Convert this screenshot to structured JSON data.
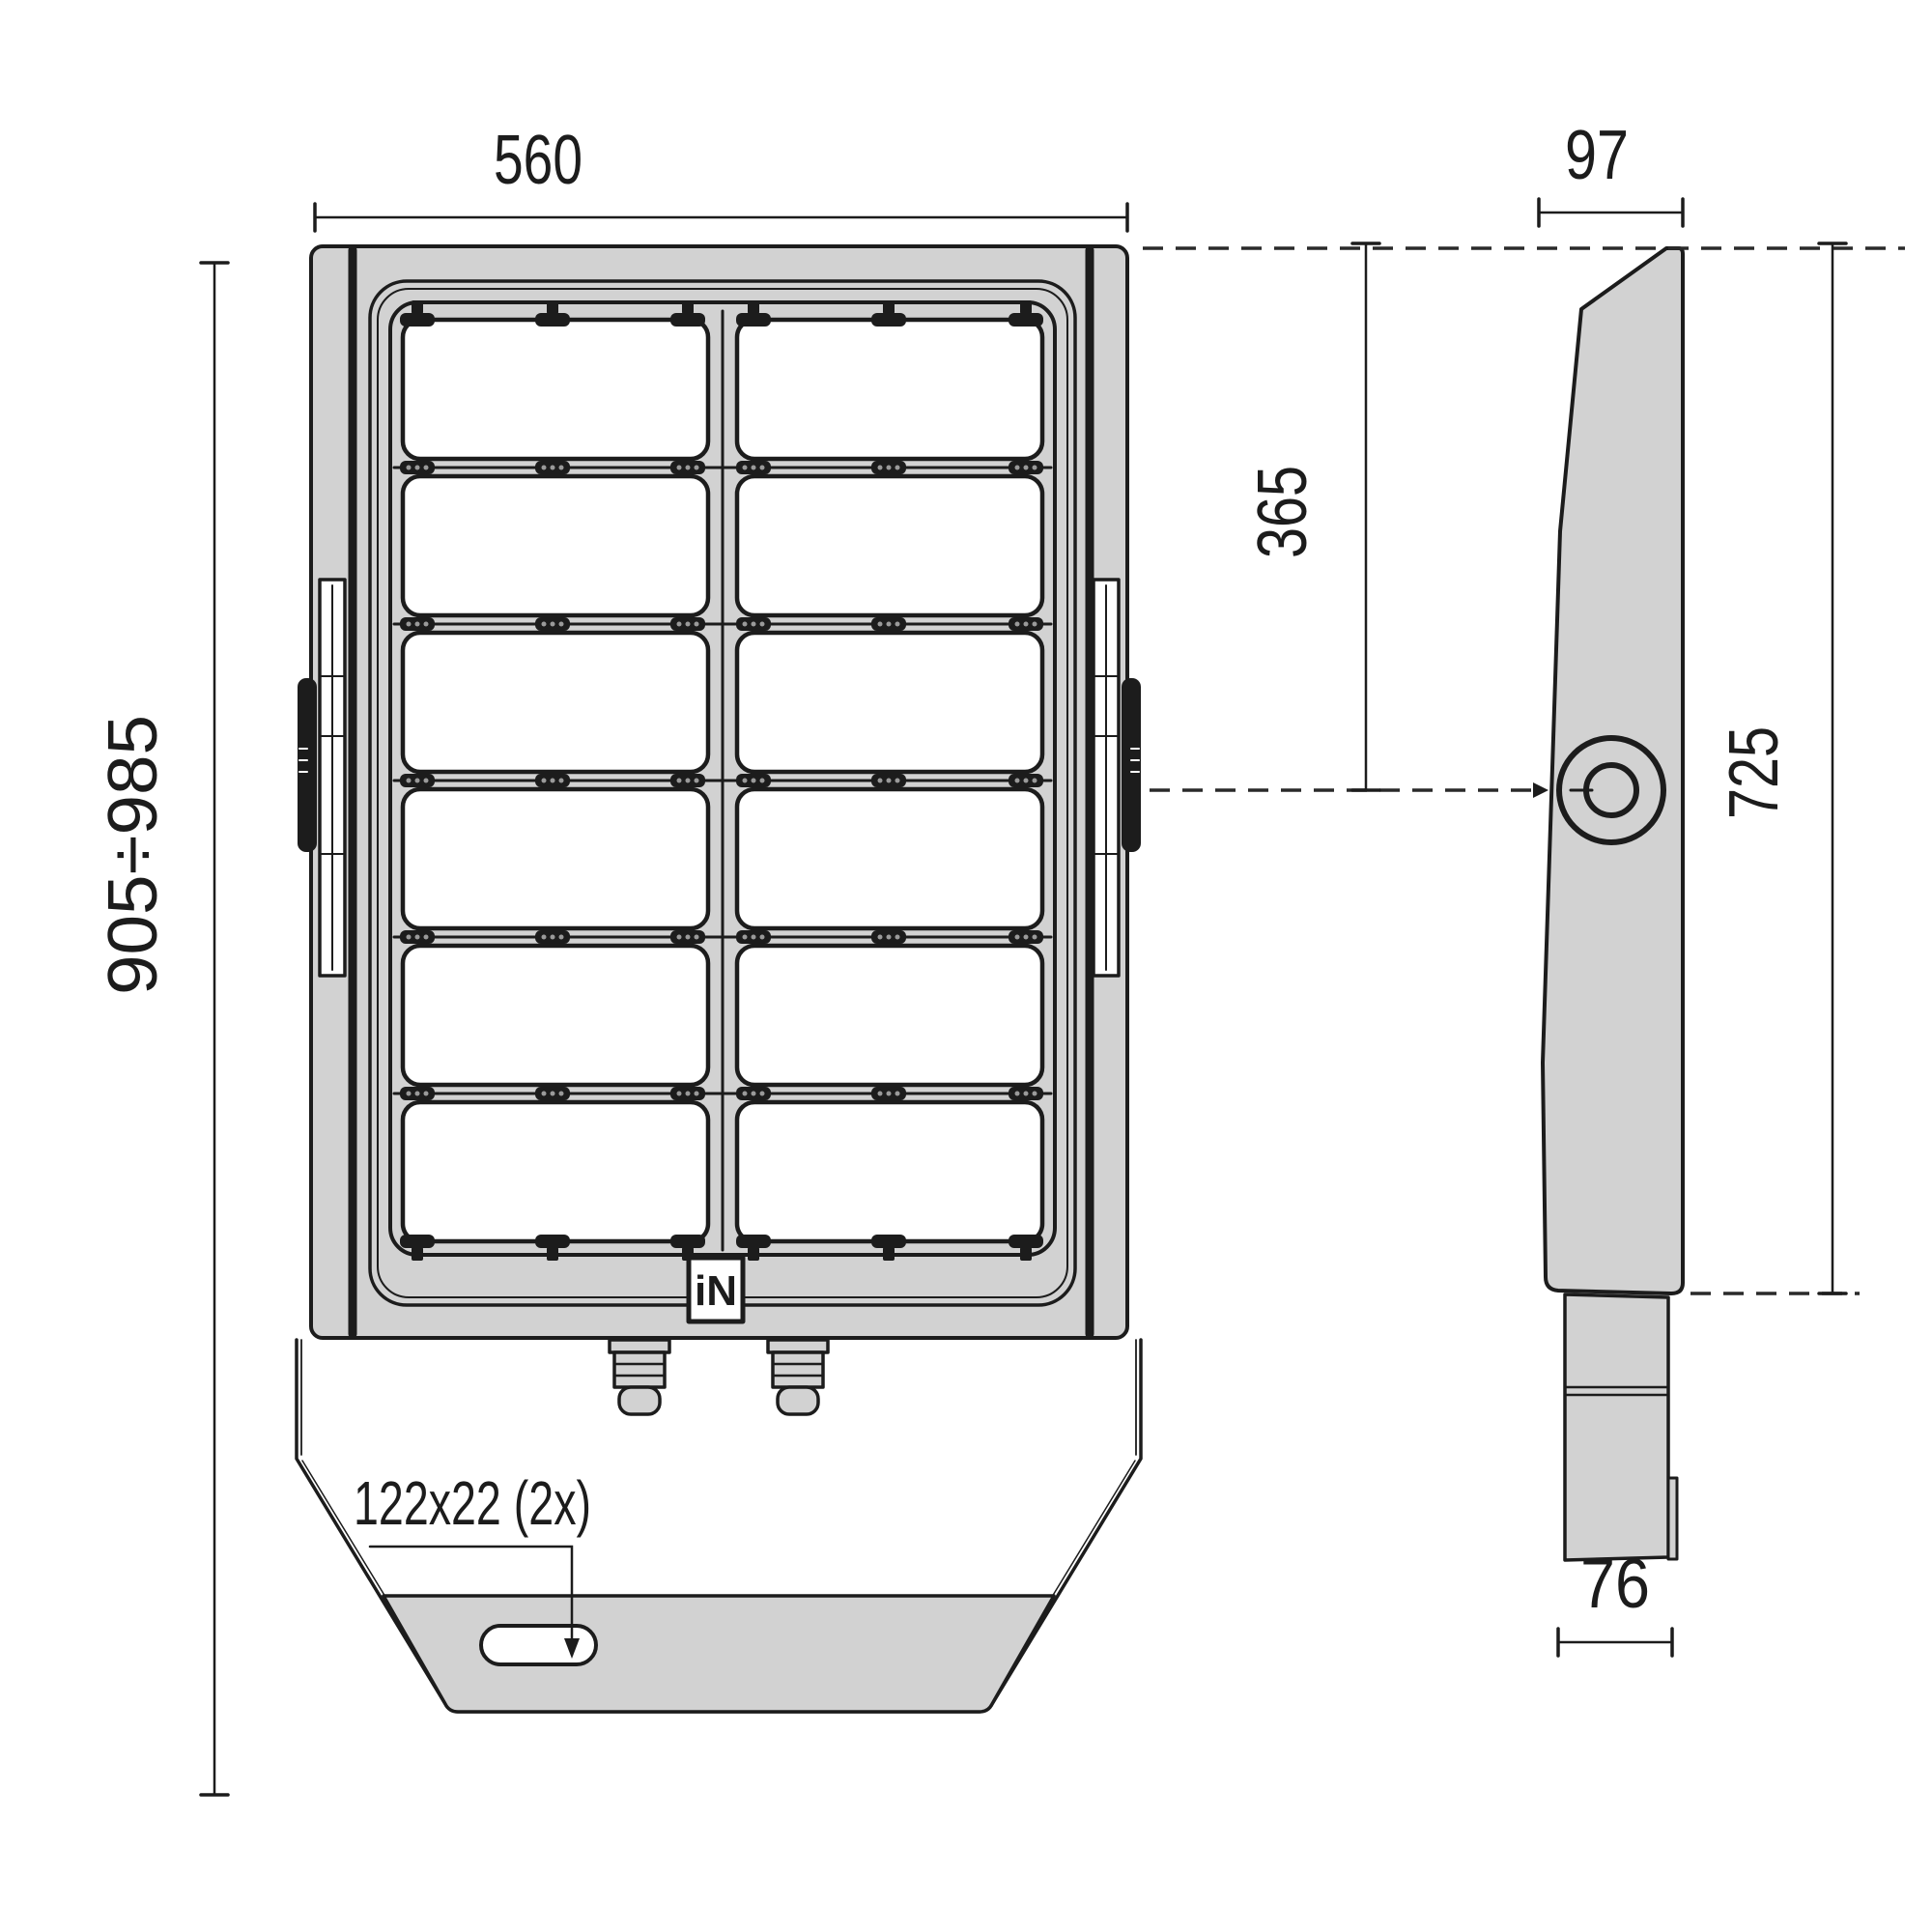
{
  "dimensions": {
    "front_width": "560",
    "side_depth": "97",
    "pivot_from_top": "365",
    "housing_height": "725",
    "overall_height": "905÷985",
    "arm_width": "76",
    "mounting_slot": "122x22 (2x)"
  },
  "logo": {
    "text": "iN"
  },
  "views": {
    "front": {
      "panel_rows": 6,
      "panel_columns": 2
    },
    "side": {
      "features": [
        "pivot-hole",
        "mounting-arm"
      ]
    }
  },
  "colors": {
    "body_fill": "#d2d2d2",
    "line": "#1c1c1c",
    "dash_line": "#2a2a2a",
    "panel_fill": "#ffffff",
    "background": "#ffffff"
  }
}
